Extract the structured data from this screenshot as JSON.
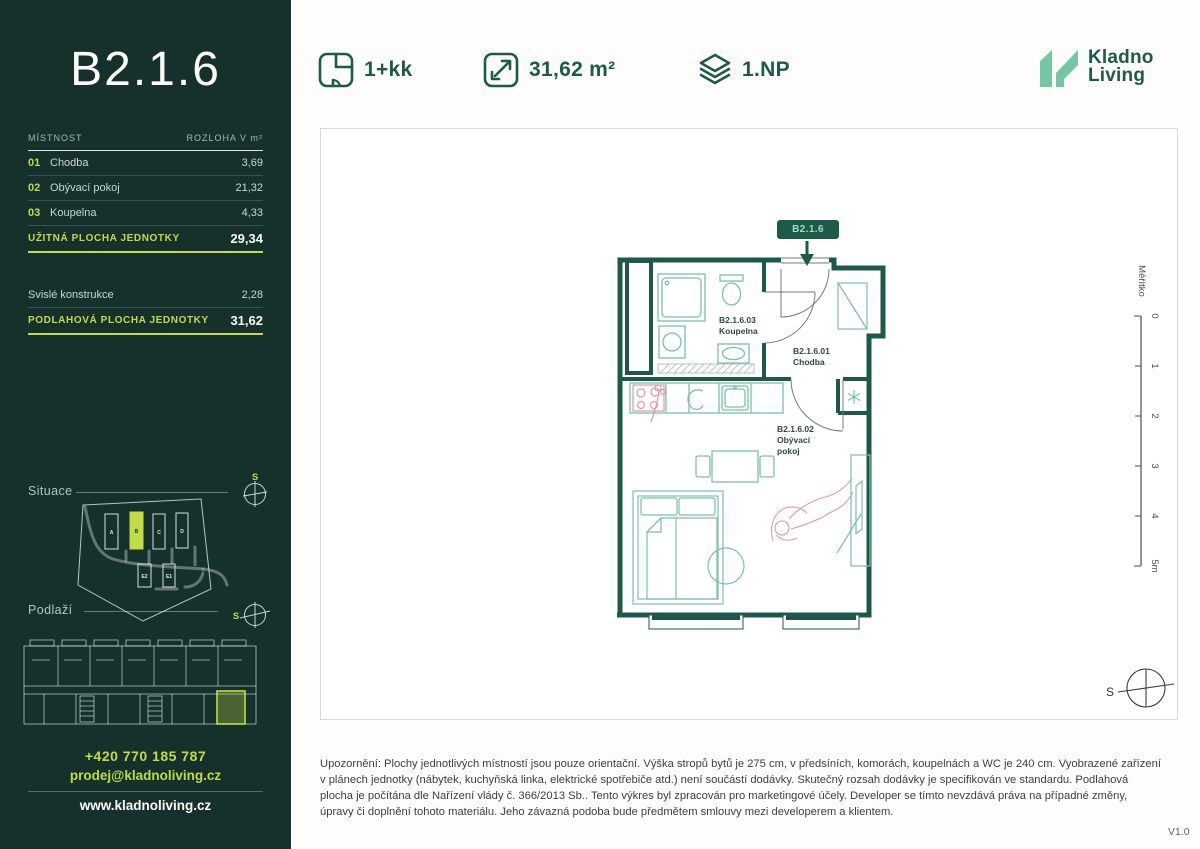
{
  "sidebar": {
    "unit_title": "B2.1.6",
    "table": {
      "header": {
        "room": "MÍSTNOST",
        "area": "ROZLOHA V m²"
      },
      "rows": [
        {
          "num": "01",
          "name": "Chodba",
          "area": "3,69"
        },
        {
          "num": "02",
          "name": "Obývací pokoj",
          "area": "21,32"
        },
        {
          "num": "03",
          "name": "Koupelna",
          "area": "4,33"
        }
      ],
      "usable": {
        "label": "UŽITNÁ PLOCHA JEDNOTKY",
        "value": "29,34"
      },
      "construction": {
        "label": "Svislé konstrukce",
        "value": "2,28"
      },
      "floor_area": {
        "label": "PODLAHOVÁ PLOCHA JEDNOTKY",
        "value": "31,62"
      }
    },
    "situace": {
      "label": "Situace",
      "compass": "S",
      "buildings": [
        "A",
        "B",
        "C",
        "D",
        "E2",
        "E1"
      ]
    },
    "podlazi": {
      "label": "Podlaží",
      "compass": "S"
    },
    "contact": {
      "phone": "+420 770 185 787",
      "email": "prodej@kladnoliving.cz",
      "website": "www.kladnoliving.cz"
    }
  },
  "header": {
    "layout_value": "1+kk",
    "area_value": "31,62 m²",
    "floor_value": "1.NP",
    "logo_line1": "Kladno",
    "logo_line2": "Living"
  },
  "plan": {
    "badge": "B2.1.6",
    "compass": "S",
    "rooms": {
      "koupelna": {
        "id": "B2.1.6.03",
        "name": "Koupelna"
      },
      "chodba": {
        "id": "B2.1.6.01",
        "name": "Chodba"
      },
      "obyvaci": {
        "id": "B2.1.6.02",
        "name": "Obývací pokoj"
      }
    },
    "scale": {
      "label": "Měřítko",
      "ticks": [
        "0",
        "1",
        "2",
        "3",
        "4",
        "5m"
      ]
    }
  },
  "disclaimer": "Upozornění: Plochy jednotlivých místností jsou pouze orientační. Výška stropů bytů je 275 cm, v předsíních, komorách, koupelnách a WC je 240 cm. Vyobrazené zařízení v plánech jednotky (nábytek, kuchyňská linka, elektrické spotřebiče atd.) není součástí dodávky. Skutečný rozsah dodávky je specifikován ve standardu. Podlahová plocha je počítána dle Nařízení vlády č. 366/2013 Sb.. Tento výkres byl zpracován pro marketingové účely. Developer se tímto nevzdává práva na případné změny, úpravy či doplnění tohoto materiálu. Jeho závazná podoba bude předmětem smlouvy mezi developerem a klientem.",
  "version": "V1.0",
  "colors": {
    "sidebar_bg": "#16312b",
    "lime_accent": "#c2dc45",
    "dark_green": "#1d5a49",
    "mint": "#74c7a2",
    "fixture_teal": "#7cc0a8",
    "sketch_pink": "#dd9aa5"
  }
}
